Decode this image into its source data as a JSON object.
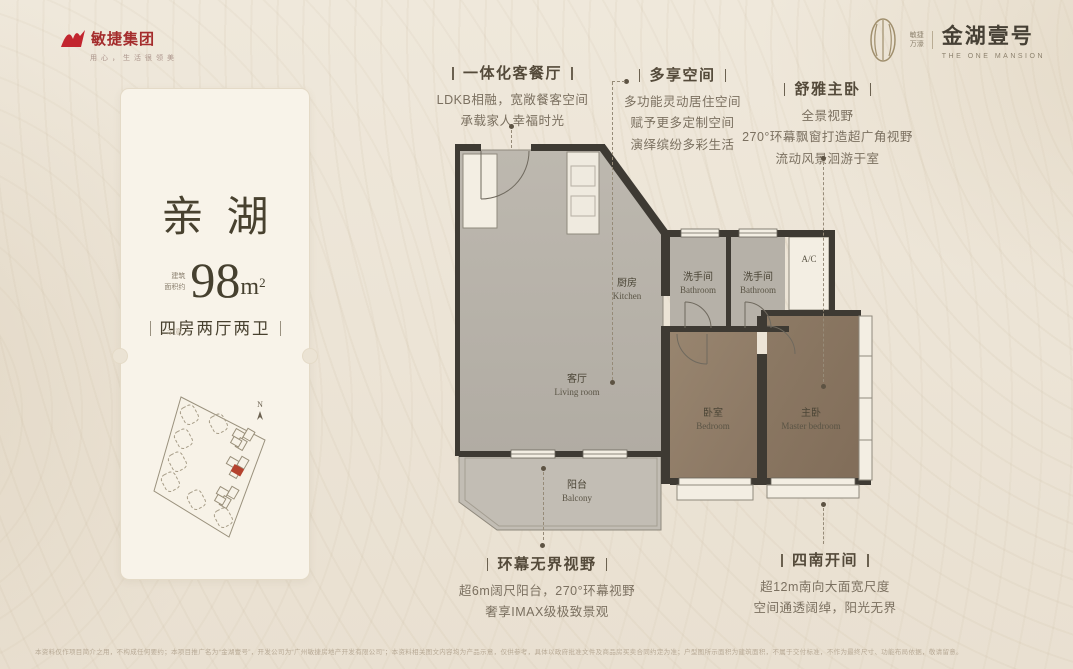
{
  "brand": {
    "group_logo": {
      "name": "敏捷集团",
      "slogan": "用心，生活很领美"
    },
    "project_logo": {
      "dev_line1": "敏捷",
      "dev_line2": "万濠",
      "name": "金湖壹号",
      "subtitle": "THE ONE MANSION"
    }
  },
  "card": {
    "title": "亲湖",
    "area": {
      "prefix_line1": "建筑",
      "prefix_line2": "面积约",
      "value": "98",
      "unit": "m",
      "sup": "2"
    },
    "layout": "四房两厅两卫",
    "note": "示意",
    "siteplan": {
      "compass": "N"
    }
  },
  "plan": {
    "kitchen": {
      "zh": "厨房",
      "en": "Kitchen"
    },
    "bath1": {
      "zh": "洗手间",
      "en": "Bathroom"
    },
    "bath2": {
      "zh": "洗手间",
      "en": "Bathroom"
    },
    "living": {
      "zh": "客厅",
      "en": "Living room"
    },
    "balcony": {
      "zh": "阳台",
      "en": "Balcony"
    },
    "bedroom": {
      "zh": "卧室",
      "en": "Bedroom"
    },
    "master": {
      "zh": "主卧",
      "en": "Master bedroom"
    },
    "ac": "A/C"
  },
  "annotations": [
    {
      "title": "一体化客餐厅",
      "lines": [
        "LDKB相融，宽敞餐客空间",
        "承载家人幸福时光"
      ]
    },
    {
      "title": "多享空间",
      "lines": [
        "多功能灵动居住空间",
        "赋予更多定制空间",
        "演绎缤纷多彩生活"
      ]
    },
    {
      "title": "舒雅主卧",
      "lines": [
        "全景视野",
        "270°环幕飘窗打造超广角视野",
        "流动风景洄游于室"
      ]
    },
    {
      "title": "环幕无界视野",
      "lines": [
        "超6m阔尺阳台，270°环幕视野",
        "奢享IMAX级极致景观"
      ]
    },
    {
      "title": "四南开间",
      "lines": [
        "超12m南向大面宽尺度",
        "空间通透阔绰，阳光无界"
      ]
    }
  ],
  "footer": {
    "disclaimer": "本资料仅作项目简介之用，不构成任何要约；本项目推广名为“金湖壹号”，开发公司为“广州敏捷房地产开发有限公司”；本资料相关图文内容均为产品示意，仅供参考，具体以政府批准文件及商品房买卖合同约定为准；户型图所示面积为建筑面积，不属于交付标准，不作为最终尺寸、功能布局依据，敬请留意。"
  },
  "colors": {
    "brand_red": "#b02a2a",
    "accent_dark": "#46402f",
    "wall": "#3e3a33",
    "floor_gray": "#b9b4ab",
    "floor_wood": "#8e7b66"
  }
}
